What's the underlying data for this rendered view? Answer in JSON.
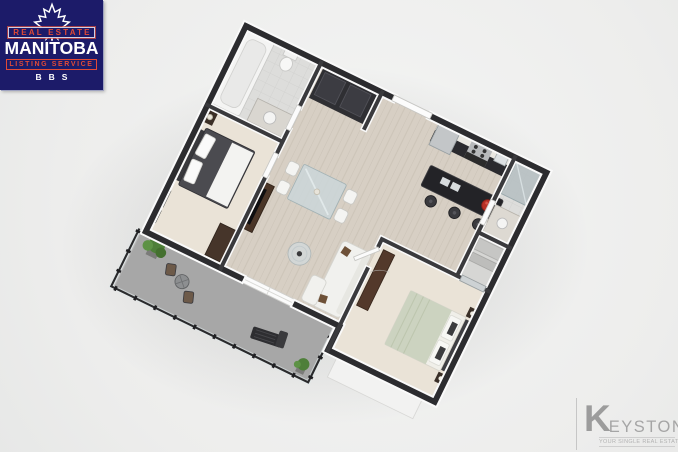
{
  "palette": {
    "page-bg": "#eff0ef",
    "mrea-bg": "#1c1b69",
    "mrea-red": "#e14a36",
    "mrea-white": "#ffffff",
    "keystone-gray": "#a3a3a3",
    "wall-dark": "#2d2d30",
    "floor-wood": "#d7cfc4",
    "floor-carpet": "#eae3d7",
    "floor-concrete": "#a7a7a7",
    "accent-fruit-red": "#b83227",
    "bedding-sage": "#ccd3c0",
    "plant-green": "#4e7f39"
  },
  "mrea_logo": {
    "line1": "REAL ESTATE",
    "line2": "MANITOBA",
    "line3": "LISTING SERVICE",
    "line4": "BBS",
    "icon": "maple-leaf-icon"
  },
  "keystone_logo": {
    "initial": "K",
    "rest": "EYSTONE",
    "tagline": "YOUR SINGLE REAL ESTATE RESOURCE",
    "icon": "keystone-shape-icon"
  },
  "floorplan": {
    "type": "3d-isometric-floorplan",
    "style": "rotated top-down render, dark charcoal wall caps, no text labels",
    "rooms": [
      {
        "name": "bathroom-1",
        "features": [
          "bathtub",
          "toilet",
          "vanity"
        ]
      },
      {
        "name": "laundry-nook",
        "features": [
          "dark-appliances"
        ]
      },
      {
        "name": "entry",
        "features": [
          "white-entry-door"
        ]
      },
      {
        "name": "kitchen",
        "features": [
          "white-upper-cabinets",
          "dark-base-cabinets",
          "fridge",
          "stove",
          "island",
          "three-bar-stools",
          "red-fruit-bowl"
        ]
      },
      {
        "name": "bathroom-2",
        "features": [
          "glass-shower",
          "vanity"
        ]
      },
      {
        "name": "walk-in-closet",
        "features": [
          "mirrored-sliding-doors"
        ]
      },
      {
        "name": "bedroom-1",
        "features": [
          "dark-bed-white-throw",
          "nightstand-lamp",
          "wall-art",
          "dresser"
        ]
      },
      {
        "name": "living-dining",
        "features": [
          "glass-dining-table",
          "four-white-chairs",
          "white-sofa-brown-pillows",
          "round-glass-coffee-table",
          "tv-console",
          "sliding-balcony-door"
        ]
      },
      {
        "name": "bedroom-2",
        "features": [
          "sage-green-bed",
          "two-nightstands",
          "long-dresser",
          "open-door",
          "window"
        ]
      },
      {
        "name": "balcony",
        "features": [
          "concrete-floor",
          "glass-and-metal-railing",
          "potted-plants",
          "bistro-table-two-chairs",
          "lounge-chair"
        ]
      }
    ]
  }
}
